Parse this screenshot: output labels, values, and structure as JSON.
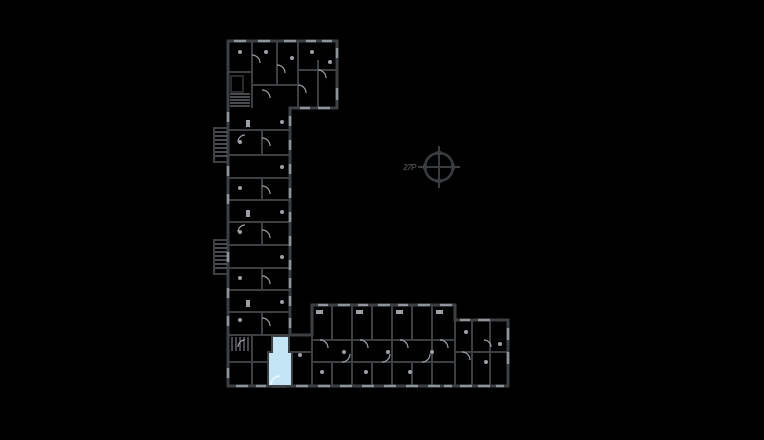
{
  "drawing": {
    "compass_label": "27P"
  },
  "icons": {
    "compass": "circled-crosshair-north-symbol"
  },
  "colors": {
    "background": "#000000",
    "wall": "#3d4043",
    "wall_light": "#8f949a",
    "detail": "#9aa0a6",
    "highlight_fill": "#c3e5f6",
    "highlight_door": "#f2f9fd",
    "compass": "#3a3d40",
    "label": "#45484b"
  }
}
